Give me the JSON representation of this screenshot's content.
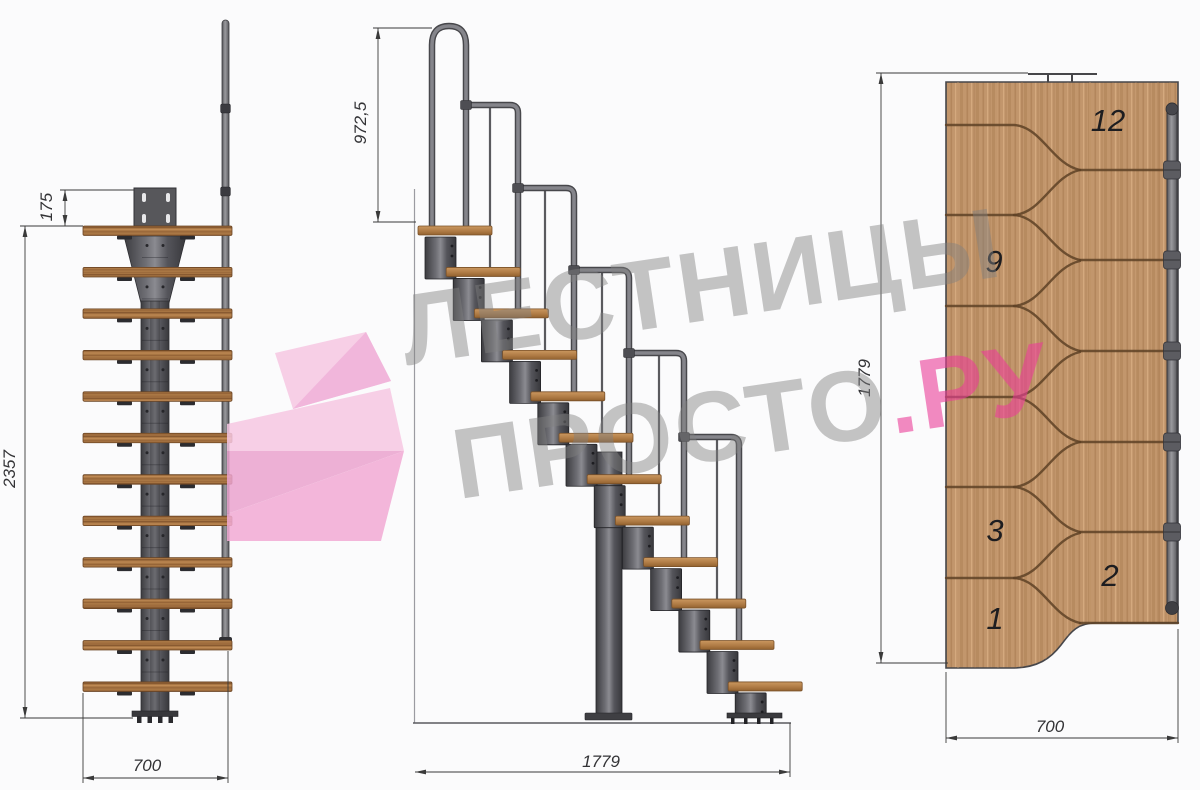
{
  "drawing": {
    "background": "#fbfbfc",
    "watermark": {
      "line1": "ЛЕСТНИЦЫ",
      "line2_gray": "ПРОСТО",
      "line2_pink": ".РУ",
      "gray_color": "#8a8a8a",
      "pink_color": "#eb3e98"
    },
    "views": {
      "front": {
        "label": "front-elevation",
        "step_count": 12,
        "dimensions": {
          "top_offset": "175",
          "height": "2357",
          "width": "700"
        }
      },
      "side": {
        "label": "side-elevation",
        "step_count": 12,
        "dimensions": {
          "handrail_height": "972,5",
          "length": "1779"
        }
      },
      "plan": {
        "label": "top-plan",
        "step_count": 12,
        "step_labels": [
          "12",
          "9",
          "3",
          "2",
          "1"
        ],
        "dimensions": {
          "length": "1779",
          "width": "700"
        }
      }
    },
    "colors": {
      "wood": "#c2966c",
      "wood_dark": "#8d6440",
      "steel_dark": "#3c3c40",
      "steel_light": "#8b8b91",
      "dimension": "#3a3a3a"
    }
  }
}
